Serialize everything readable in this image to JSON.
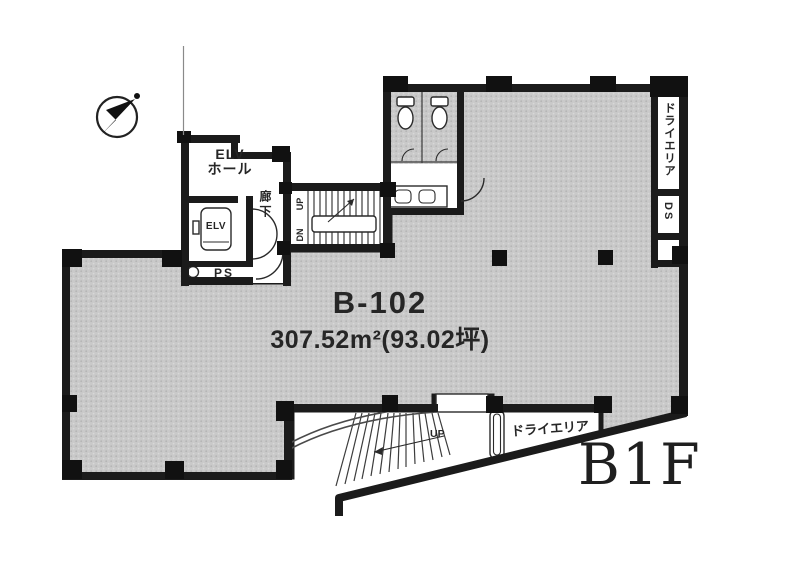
{
  "plan": {
    "unit_label": "B-102",
    "area_label": "307.52m²(93.02坪)",
    "floor_label": "B1F",
    "rooms": {
      "elv_hall_line1": "ELV",
      "elv_hall_line2": "ホール",
      "elevator_car": "ELV",
      "pipe_space": "PS",
      "corridor": "廊下"
    },
    "internal_stairs": {
      "up": "UP",
      "down": "DN"
    },
    "right_shaft": {
      "dry_area": "ドライエリア",
      "duct_space": "DS"
    },
    "exterior": {
      "dry_area": "ドライエリア",
      "stair_up": "UP"
    },
    "icons": {
      "compass": "north-arrow-icon"
    },
    "colors": {
      "wall": "#1b1b1b",
      "floor_fill": "#c9c9c9",
      "background": "#ffffff",
      "text": "#262626"
    }
  }
}
